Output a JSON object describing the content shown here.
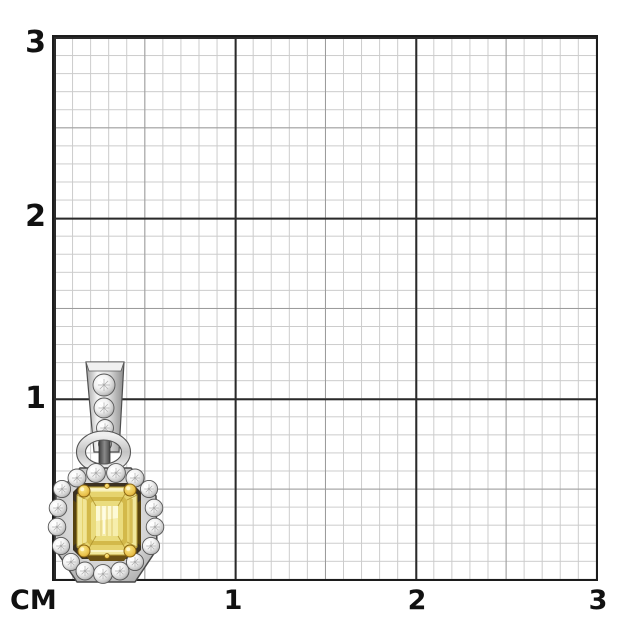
{
  "ruler": {
    "unit_label": "СМ",
    "left_labels": [
      "3",
      "2",
      "1"
    ],
    "bottom_labels": [
      "1",
      "2",
      "3"
    ],
    "grid_colors": {
      "minor_1mm": "#cbcbcb",
      "mid_5mm": "#9b9b9b",
      "major_1cm": "#2a2a2a",
      "border": "#1c1c1c"
    }
  },
  "pendant": {
    "description": "White-gold pendant: emerald-cut fancy yellow diamond in yellow-gold prongs, round-diamond halo, diamond-set tapered bail on jump ring",
    "colors": {
      "metal": "#d9d9d9",
      "metal_outline": "#4a4a4a",
      "stone_light": "#f1e79c",
      "stone_mid": "#e6d36e",
      "stone_deep": "#d3b94a",
      "stone_inner": "#eadc7e",
      "stone_table": "#f6eeac",
      "table_highlight": "#fdfad8",
      "basket_dark": "#3b3122",
      "gallery_gold": "#6b5113",
      "gallery_shadow": "#57430f",
      "prong_gold": "#e9c04a",
      "prong_outline": "#8a6410"
    },
    "bail_stones": [
      [
        104,
        385,
        11
      ],
      [
        104,
        408,
        10
      ],
      [
        105,
        428,
        8.5
      ],
      [
        105,
        444,
        6.5
      ]
    ],
    "halo_stones": [
      [
        62,
        489,
        8.6
      ],
      [
        77,
        478,
        9
      ],
      [
        96,
        473,
        9.4
      ],
      [
        116,
        473,
        9.4
      ],
      [
        135,
        478,
        9
      ],
      [
        149,
        489,
        8.6
      ],
      [
        58,
        508,
        8.8
      ],
      [
        57,
        527,
        8.8
      ],
      [
        61,
        546,
        8.6
      ],
      [
        154,
        508,
        8.8
      ],
      [
        155,
        527,
        8.8
      ],
      [
        151,
        546,
        8.6
      ],
      [
        71,
        562,
        8.6
      ],
      [
        85,
        571,
        9
      ],
      [
        103,
        574,
        9.4
      ],
      [
        120,
        571,
        9
      ],
      [
        135,
        562,
        8.6
      ]
    ]
  }
}
